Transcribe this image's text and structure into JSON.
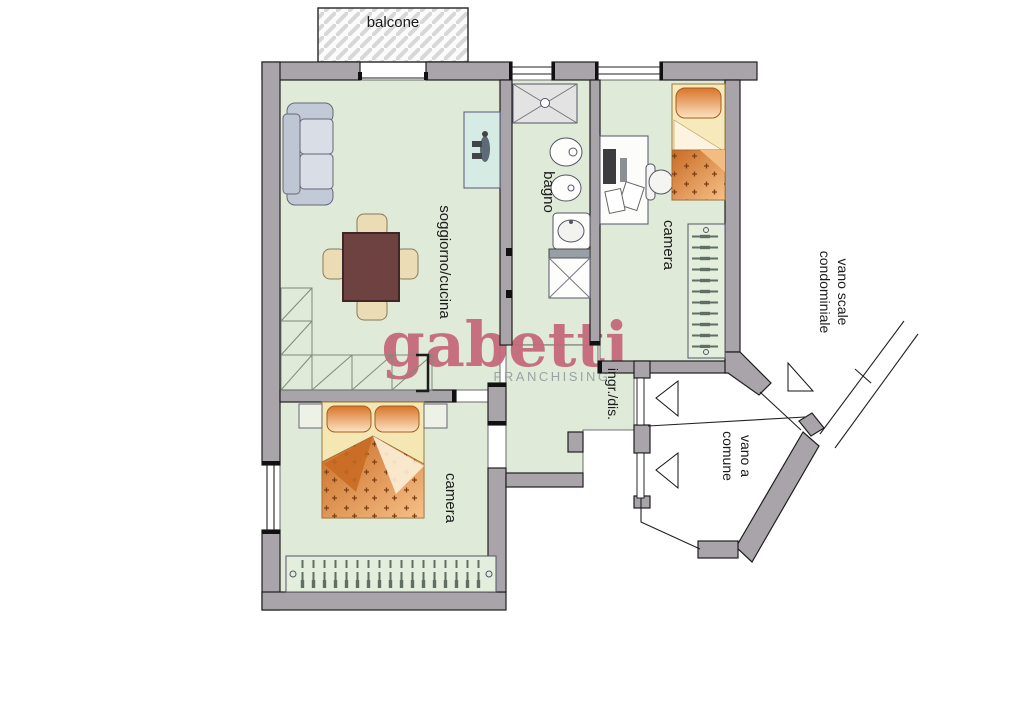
{
  "plan": {
    "balcony": {
      "label": "balcone"
    },
    "living_kitchen": {
      "label": "soggiorno/cucina"
    },
    "bathroom": {
      "label": "bagno"
    },
    "bedroom_right": {
      "label": "camera"
    },
    "bedroom_bottom": {
      "label": "camera"
    },
    "entry_hall": {
      "label": "ingr./dis."
    },
    "stairwell": {
      "line1": "vano scale",
      "line2": "condominiale"
    },
    "common_landing": {
      "line1": "vano a",
      "line2": "comune"
    }
  },
  "watermark": {
    "brand": "gabetti",
    "subtitle": "FRANCHISING"
  },
  "colors": {
    "floor_green": "#dfead8",
    "wall_gray": "#a8a4aa",
    "brand_rose": "#c4697b",
    "subtitle_gray": "#999fa2",
    "furniture_orange": "#d9742a",
    "table_brown": "#6f4242",
    "counter_teal": "#d6ebe4",
    "sofa_gray": "#cfd5e0"
  }
}
